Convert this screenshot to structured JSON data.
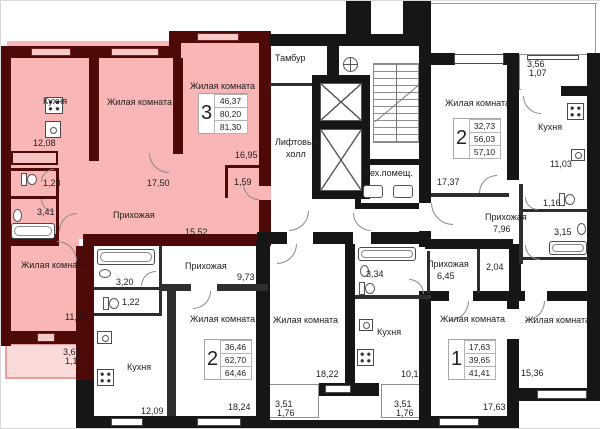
{
  "colors": {
    "highlight_fill": "#f8b6b6",
    "highlight_wall": "#4e0909",
    "wall": "#161616",
    "balcony_highlight_border": "#ef9c9c"
  },
  "core": {
    "vestibule": "Тамбур",
    "elevator_hall_line1": "Лифтовый",
    "elevator_hall_line2": "холл",
    "tech_room": "Тех.помещ."
  },
  "apt3": {
    "badge": "3",
    "total_living": "46,37",
    "total": "80,20",
    "total_with_balcony": "81,30",
    "kitchen": {
      "label": "Кухня",
      "area": "12,08"
    },
    "living1": {
      "label": "Жилая комната",
      "area": "17,50"
    },
    "living2": {
      "label": "Жилая комната",
      "area": "16,95"
    },
    "living3": {
      "label": "Жилая комната",
      "area": "11,92"
    },
    "hall": {
      "label": "Прихожая",
      "area": "15,52"
    },
    "wc": {
      "area": "1,23"
    },
    "bath": {
      "area": "3,41"
    },
    "closet": {
      "area": "1,59"
    },
    "balcony": {
      "area_full": "3,68",
      "area_half": "1,10"
    }
  },
  "apt2_top": {
    "badge": "2",
    "total_living": "32,73",
    "total": "56,03",
    "total_with_balcony": "57,10",
    "living1": {
      "label": "Жилая комната",
      "area": "17,37"
    },
    "living2": {
      "label": "Жилая комната",
      "area": "15,36"
    },
    "kitchen": {
      "label": "Кухня",
      "area": "11,03"
    },
    "hall": {
      "label": "Прихожая",
      "area": "7,96"
    },
    "wc": {
      "area": "1,16"
    },
    "bath": {
      "area": "3,15"
    },
    "balcony": {
      "area_full": "3,56",
      "area_half": "1,07"
    }
  },
  "apt2_bottom": {
    "badge": "2",
    "total_living": "36,46",
    "total": "62,70",
    "total_with_balcony": "64,46",
    "living1": {
      "label": "Жилая комната",
      "area": "18,24"
    },
    "living2": {
      "label": "Жилая комната",
      "area": "18,22"
    },
    "kitchen": {
      "label": "Кухня",
      "area": "12,09"
    },
    "hall": {
      "label": "Прихожая",
      "area": "9,73"
    },
    "bath": {
      "area": "3,20"
    },
    "wc": {
      "area": "1,22"
    },
    "balcony": {
      "area_full": "3,51",
      "area_half": "1,76"
    }
  },
  "apt1": {
    "badge": "1",
    "total_living": "17,63",
    "total": "39,65",
    "total_with_balcony": "41,41",
    "living1": {
      "label": "Жилая комната",
      "area": "17,63"
    },
    "kitchen": {
      "label": "Кухня",
      "area": "10,19"
    },
    "hall": {
      "label": "Прихожая",
      "area": "6,45"
    },
    "closet": {
      "area": "2,04"
    },
    "bath": {
      "area": "3,34"
    },
    "balcony": {
      "area_full": "3,51",
      "area_half": "1,76"
    }
  }
}
